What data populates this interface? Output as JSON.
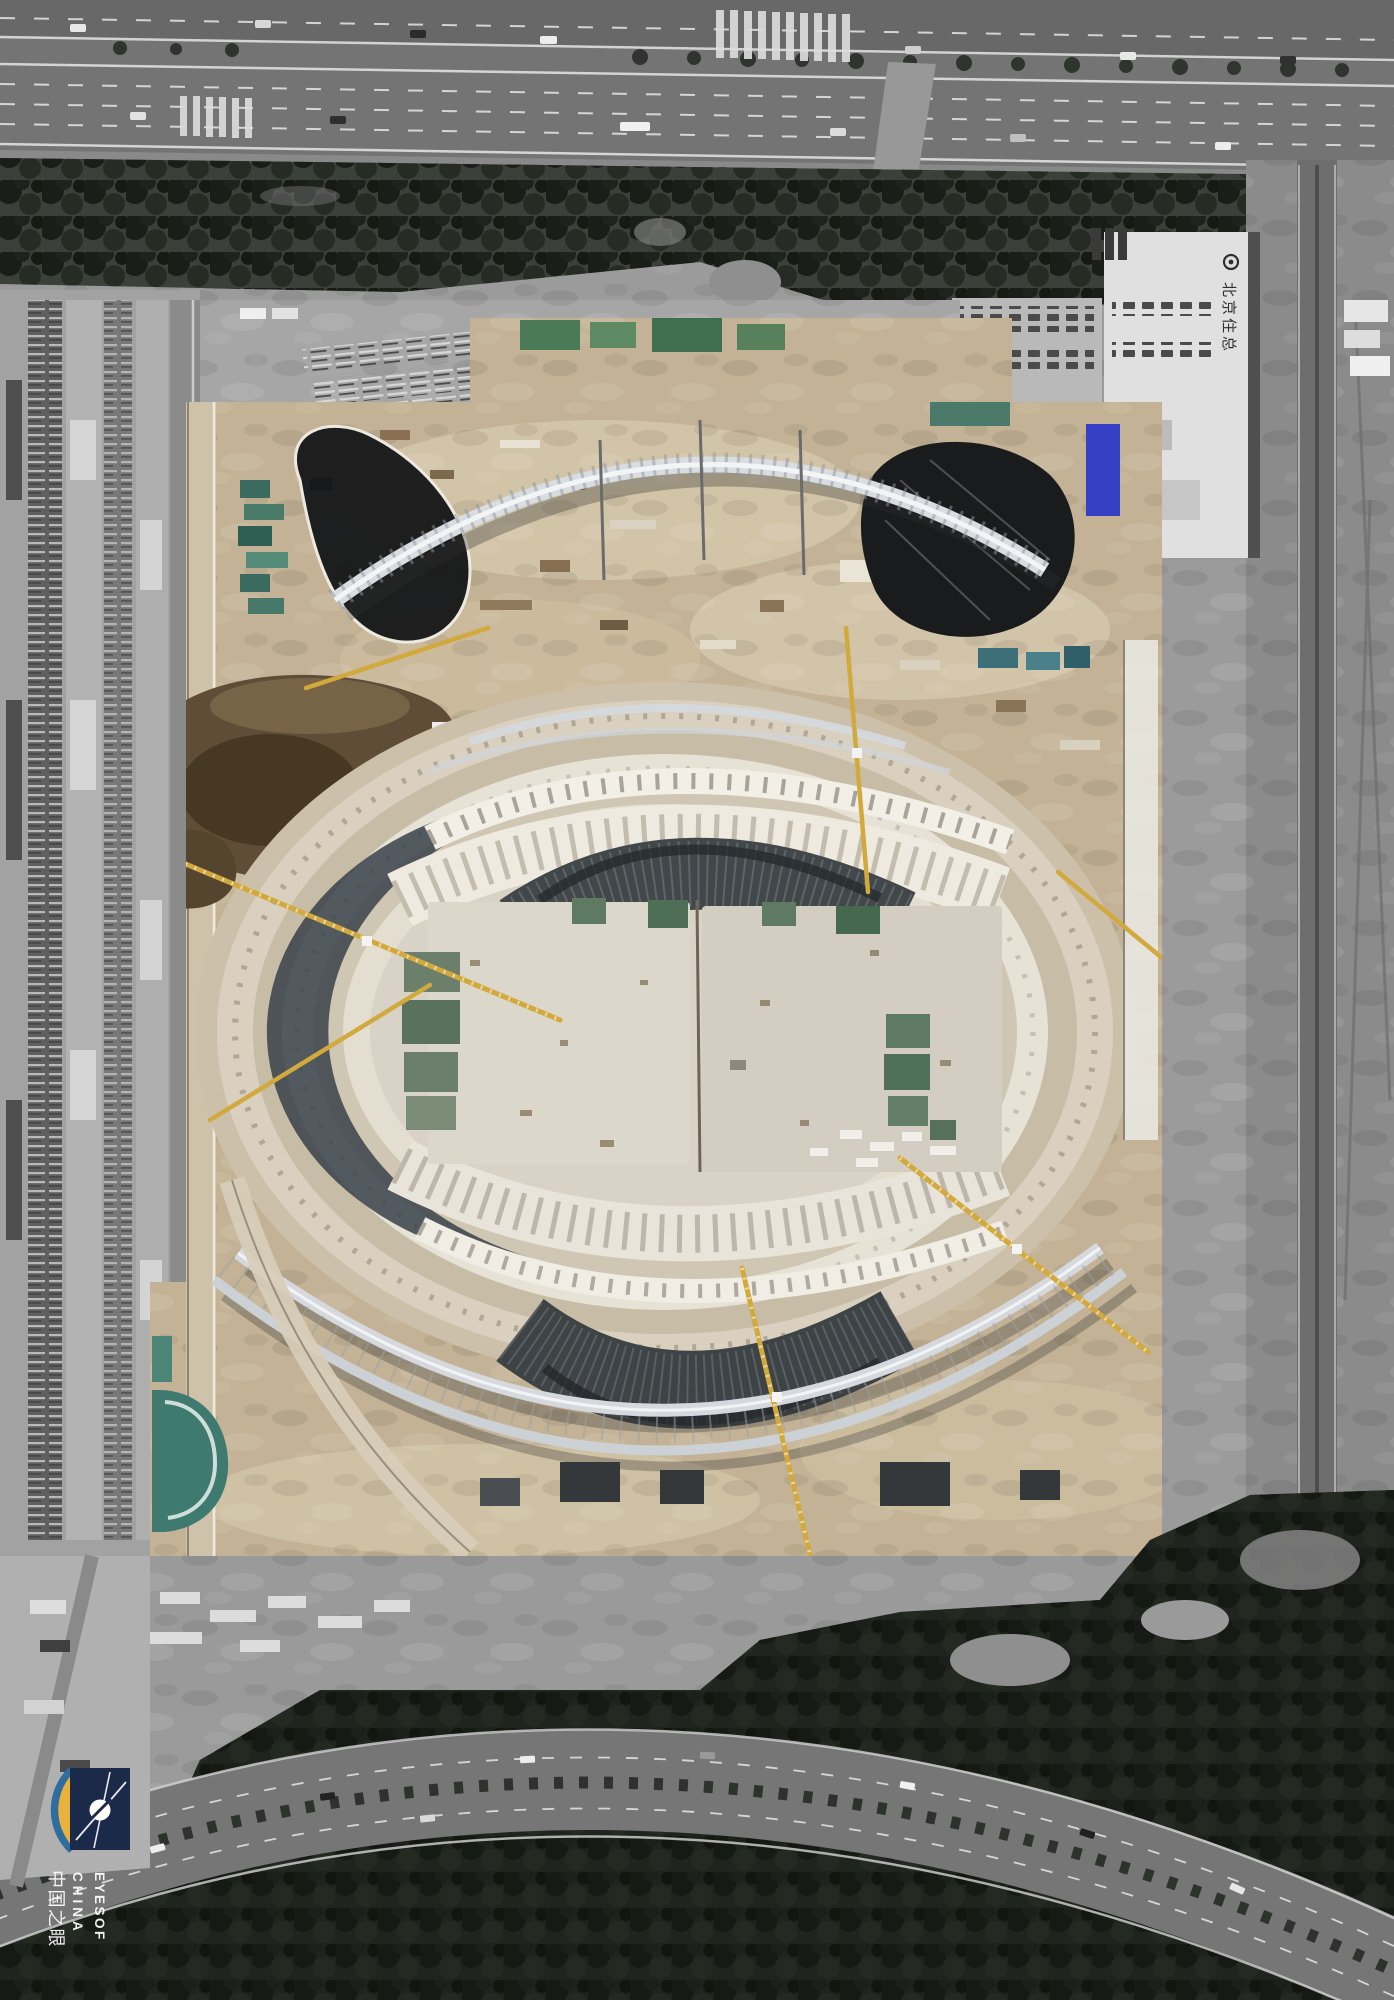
{
  "scene": {
    "type": "satellite-aerial-photo",
    "subject": "Oval stadium under construction, color construction site surrounded by desaturated grayscale city blocks, highway on top, tree-lined curved boulevard at bottom"
  },
  "watermark": {
    "name": "Eyes of China logo",
    "line1": "EYESOF",
    "line2": "CHINA",
    "line3": "中国之眼"
  },
  "building_sign": {
    "text": "北京住总"
  },
  "palette": {
    "ground_gray": "#9b9b9b",
    "road_gray": "#757575",
    "forest_dark": "#20241f",
    "ground_tan": "#c3b295",
    "concrete_light": "#e6e1d4",
    "steel_silver": "#d6dade",
    "shadow_slate": "#333d44",
    "crane_yellow": "#d2a93c",
    "tarp_green": "#5d7a5f",
    "tarp_blue": "#3640c4",
    "teal_deck": "#3e7a70",
    "dirt_brown": "#5e4b34",
    "logo_navy": "#1c2a4a",
    "logo_gold": "#e9b23d",
    "logo_blue": "#2f6d9e"
  }
}
